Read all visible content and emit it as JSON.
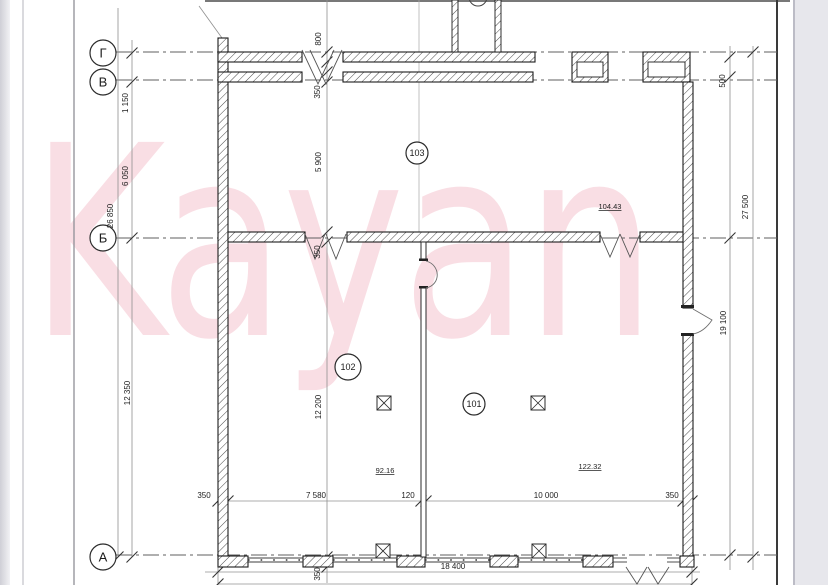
{
  "drawing_type": "architectural-floor-plan-scan",
  "watermark": "Kayan",
  "axes": [
    {
      "label": "Г"
    },
    {
      "label": "В"
    },
    {
      "label": "Б"
    },
    {
      "label": "А"
    }
  ],
  "rooms": [
    {
      "number": "103",
      "area": "104.43"
    },
    {
      "number": "102",
      "area": "92.16"
    },
    {
      "number": "101",
      "area": "122.32"
    }
  ],
  "dimensions": {
    "left": {
      "total": "26 850",
      "segments": [
        "1 150",
        "6 050",
        "12 350"
      ]
    },
    "interior_vertical": [
      "800",
      "350",
      "5 900",
      "350",
      "12 200",
      "350"
    ],
    "right": {
      "top": "500",
      "total": "27 500",
      "lower": "19 100"
    },
    "bottom": {
      "segments": [
        "350",
        "7 580",
        "120",
        "10 000",
        "350"
      ],
      "total": "18 400"
    }
  },
  "colors": {
    "paper": "#ffffff",
    "margin_gray": "#e7e7ec",
    "frame_dark": "#3a3a3a",
    "wall_line": "#1b1b1b",
    "hatch_line": "#4a4a4a",
    "dim_line": "#909090",
    "watermark_pink": "#de4669"
  }
}
